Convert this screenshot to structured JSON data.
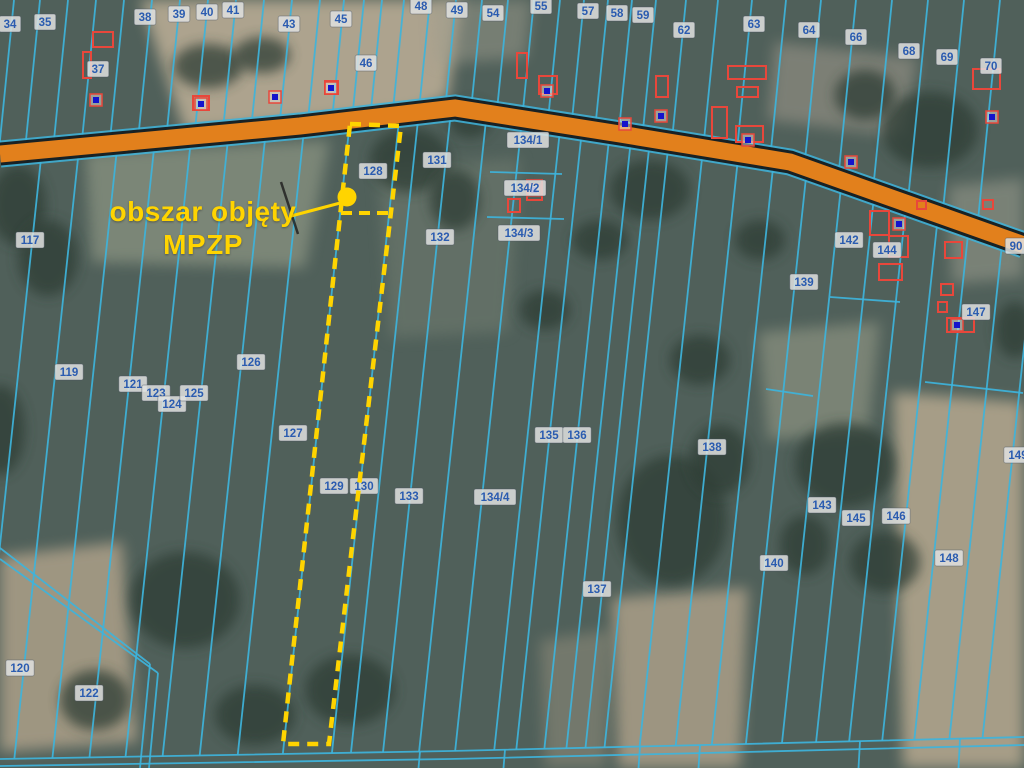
{
  "map": {
    "annotation": {
      "line1": "obszar objęty",
      "line2": "MPZP"
    },
    "colors": {
      "parcel_line": "#3eb4dc",
      "road_fill": "#e2801c",
      "road_casing": "#161616",
      "highlight": "#ffd400",
      "label_text": "#2b5cb0",
      "label_bg": "rgba(224,226,224,0.85)",
      "building": "#e8473b",
      "marker_blue": "#1414cc",
      "terrain_base": "#50605a"
    },
    "road": {
      "path": [
        [
          0,
          154
        ],
        [
          300,
          126
        ],
        [
          455,
          108
        ],
        [
          620,
          134
        ],
        [
          790,
          162
        ],
        [
          1024,
          245
        ]
      ]
    },
    "bottom_paths": [
      [
        [
          0,
          759
        ],
        [
          450,
          751
        ],
        [
          745,
          744
        ],
        [
          1024,
          737
        ]
      ],
      [
        [
          0,
          766
        ],
        [
          450,
          759
        ],
        [
          745,
          752
        ],
        [
          1024,
          745
        ]
      ]
    ],
    "diag_paths": [
      [
        [
          0,
          548
        ],
        [
          150,
          664
        ]
      ],
      [
        [
          0,
          559
        ],
        [
          158,
          673
        ]
      ],
      [
        [
          150,
          664
        ],
        [
          140,
          768
        ]
      ],
      [
        [
          158,
          673
        ],
        [
          149,
          768
        ]
      ]
    ],
    "extra_segments": [
      [
        [
          490,
          172
        ],
        [
          562,
          174
        ]
      ],
      [
        [
          487,
          217
        ],
        [
          564,
          219
        ]
      ],
      [
        [
          830,
          297
        ],
        [
          900,
          302
        ]
      ],
      [
        [
          925,
          382
        ],
        [
          1023,
          393
        ]
      ],
      [
        [
          766,
          389
        ],
        [
          813,
          396
        ]
      ]
    ],
    "stub_xs": [
      420,
      505,
      640,
      700,
      860,
      960
    ],
    "lines_below_x400": [
      15,
      52,
      90,
      127,
      163,
      200,
      237,
      275,
      320,
      369,
      388,
      420,
      456,
      492,
      531,
      553,
      581,
      603,
      622,
      641,
      676,
      712,
      748,
      782,
      818,
      852,
      885,
      918,
      950,
      985,
      1018
    ],
    "lines_above_x60": [
      8,
      34,
      62,
      90,
      118,
      146,
      174,
      202,
      230,
      258,
      286,
      314,
      338,
      358,
      376,
      398,
      424,
      450,
      476,
      502,
      528,
      554,
      578,
      602,
      626,
      650,
      680,
      712,
      746,
      780,
      815,
      850,
      886,
      922,
      958,
      994
    ],
    "parcel_labels": [
      {
        "text": "34",
        "x": 10,
        "y": 24
      },
      {
        "text": "35",
        "x": 45,
        "y": 22
      },
      {
        "text": "37",
        "x": 98,
        "y": 69
      },
      {
        "text": "38",
        "x": 145,
        "y": 17
      },
      {
        "text": "39",
        "x": 179,
        "y": 14
      },
      {
        "text": "40",
        "x": 207,
        "y": 12
      },
      {
        "text": "41",
        "x": 233,
        "y": 10
      },
      {
        "text": "43",
        "x": 289,
        "y": 24
      },
      {
        "text": "45",
        "x": 341,
        "y": 19
      },
      {
        "text": "46",
        "x": 366,
        "y": 63
      },
      {
        "text": "48",
        "x": 421,
        "y": 6
      },
      {
        "text": "49",
        "x": 457,
        "y": 10
      },
      {
        "text": "54",
        "x": 493,
        "y": 13
      },
      {
        "text": "55",
        "x": 541,
        "y": 6
      },
      {
        "text": "57",
        "x": 588,
        "y": 11
      },
      {
        "text": "58",
        "x": 617,
        "y": 13
      },
      {
        "text": "59",
        "x": 643,
        "y": 15
      },
      {
        "text": "62",
        "x": 684,
        "y": 30
      },
      {
        "text": "63",
        "x": 754,
        "y": 24
      },
      {
        "text": "64",
        "x": 809,
        "y": 30
      },
      {
        "text": "66",
        "x": 856,
        "y": 37
      },
      {
        "text": "68",
        "x": 909,
        "y": 51
      },
      {
        "text": "69",
        "x": 947,
        "y": 57
      },
      {
        "text": "70",
        "x": 991,
        "y": 66
      },
      {
        "text": "90",
        "x": 1016,
        "y": 246
      },
      {
        "text": "117",
        "x": 30,
        "y": 240
      },
      {
        "text": "119",
        "x": 69,
        "y": 372
      },
      {
        "text": "120",
        "x": 20,
        "y": 668
      },
      {
        "text": "121",
        "x": 133,
        "y": 384
      },
      {
        "text": "122",
        "x": 89,
        "y": 693
      },
      {
        "text": "123",
        "x": 156,
        "y": 393
      },
      {
        "text": "124",
        "x": 172,
        "y": 404
      },
      {
        "text": "125",
        "x": 194,
        "y": 393
      },
      {
        "text": "126",
        "x": 251,
        "y": 362
      },
      {
        "text": "127",
        "x": 293,
        "y": 433
      },
      {
        "text": "128",
        "x": 373,
        "y": 171
      },
      {
        "text": "129",
        "x": 334,
        "y": 486
      },
      {
        "text": "130",
        "x": 364,
        "y": 486
      },
      {
        "text": "131",
        "x": 437,
        "y": 160
      },
      {
        "text": "132",
        "x": 440,
        "y": 237
      },
      {
        "text": "133",
        "x": 409,
        "y": 496
      },
      {
        "text": "134/1",
        "x": 528,
        "y": 140
      },
      {
        "text": "134/2",
        "x": 525,
        "y": 188
      },
      {
        "text": "134/3",
        "x": 519,
        "y": 233
      },
      {
        "text": "134/4",
        "x": 495,
        "y": 497
      },
      {
        "text": "135",
        "x": 549,
        "y": 435
      },
      {
        "text": "136",
        "x": 577,
        "y": 435
      },
      {
        "text": "137",
        "x": 597,
        "y": 589
      },
      {
        "text": "138",
        "x": 712,
        "y": 447
      },
      {
        "text": "139",
        "x": 804,
        "y": 282
      },
      {
        "text": "140",
        "x": 774,
        "y": 563
      },
      {
        "text": "142",
        "x": 849,
        "y": 240
      },
      {
        "text": "143",
        "x": 822,
        "y": 505
      },
      {
        "text": "144",
        "x": 887,
        "y": 250
      },
      {
        "text": "145",
        "x": 856,
        "y": 518
      },
      {
        "text": "146",
        "x": 896,
        "y": 516
      },
      {
        "text": "147",
        "x": 976,
        "y": 312
      },
      {
        "text": "148",
        "x": 949,
        "y": 558
      },
      {
        "text": "149",
        "x": 1018,
        "y": 455
      }
    ],
    "buildings": [
      [
        93,
        32,
        20,
        15
      ],
      [
        83,
        52,
        8,
        26
      ],
      [
        193,
        96,
        16,
        14
      ],
      [
        325,
        81,
        13,
        13
      ],
      [
        517,
        53,
        10,
        25
      ],
      [
        539,
        76,
        18,
        18
      ],
      [
        728,
        66,
        38,
        13
      ],
      [
        737,
        87,
        21,
        10
      ],
      [
        712,
        107,
        15,
        31
      ],
      [
        736,
        126,
        27,
        16
      ],
      [
        973,
        69,
        27,
        20
      ],
      [
        656,
        76,
        12,
        21
      ],
      [
        870,
        211,
        19,
        24
      ],
      [
        889,
        236,
        19,
        21
      ],
      [
        879,
        264,
        23,
        16
      ],
      [
        945,
        242,
        17,
        16
      ],
      [
        941,
        284,
        12,
        11
      ],
      [
        938,
        302,
        9,
        10
      ],
      [
        947,
        318,
        27,
        14
      ],
      [
        508,
        199,
        12,
        13
      ],
      [
        527,
        180,
        15,
        20
      ],
      [
        917,
        201,
        9,
        8
      ],
      [
        983,
        200,
        10,
        9
      ]
    ],
    "markers": [
      [
        96,
        100
      ],
      [
        201,
        104
      ],
      [
        275,
        97
      ],
      [
        331,
        88
      ],
      [
        547,
        91
      ],
      [
        625,
        124
      ],
      [
        748,
        140
      ],
      [
        851,
        162
      ],
      [
        661,
        116
      ],
      [
        899,
        224
      ],
      [
        957,
        325
      ],
      [
        992,
        117
      ],
      [
        534,
        190
      ]
    ],
    "terrain_fields": [
      {
        "pts": [
          [
            140,
            0
          ],
          [
            462,
            0
          ],
          [
            448,
            98
          ],
          [
            412,
            112
          ],
          [
            185,
            132
          ]
        ],
        "fill": "#b2a791",
        "op": 0.95
      },
      {
        "pts": [
          [
            85,
            152
          ],
          [
            330,
            140
          ],
          [
            305,
            268
          ],
          [
            92,
            262
          ]
        ],
        "fill": "#86907f",
        "op": 0.8
      },
      {
        "pts": [
          [
            378,
            168
          ],
          [
            520,
            158
          ],
          [
            508,
            332
          ],
          [
            390,
            338
          ]
        ],
        "fill": "#6e7a6e",
        "op": 0.6
      },
      {
        "pts": [
          [
            0,
            556
          ],
          [
            122,
            542
          ],
          [
            138,
            742
          ],
          [
            0,
            752
          ]
        ],
        "fill": "#a79c86",
        "op": 0.9
      },
      {
        "pts": [
          [
            612,
            598
          ],
          [
            748,
            588
          ],
          [
            740,
            768
          ],
          [
            618,
            768
          ]
        ],
        "fill": "#ab9f88",
        "op": 0.85
      },
      {
        "pts": [
          [
            893,
            392
          ],
          [
            1024,
            402
          ],
          [
            1024,
            768
          ],
          [
            903,
            768
          ]
        ],
        "fill": "#b0a48c",
        "op": 0.9
      },
      {
        "pts": [
          [
            758,
            332
          ],
          [
            880,
            322
          ],
          [
            868,
            432
          ],
          [
            768,
            440
          ]
        ],
        "fill": "#8c9381",
        "op": 0.7
      },
      {
        "pts": [
          [
            948,
            186
          ],
          [
            1024,
            178
          ],
          [
            1024,
            278
          ],
          [
            952,
            284
          ]
        ],
        "fill": "#95988a",
        "op": 0.6
      },
      {
        "pts": [
          [
            432,
            0
          ],
          [
            532,
            0
          ],
          [
            526,
            58
          ],
          [
            436,
            64
          ]
        ],
        "fill": "#9d9c8d",
        "op": 0.5
      },
      {
        "pts": [
          [
            775,
            42
          ],
          [
            918,
            58
          ],
          [
            902,
            136
          ],
          [
            768,
            120
          ]
        ],
        "fill": "#9a9488",
        "op": 0.6
      },
      {
        "pts": [
          [
            540,
            640
          ],
          [
            612,
            630
          ],
          [
            606,
            768
          ],
          [
            545,
            768
          ]
        ],
        "fill": "#97917e",
        "op": 0.5
      }
    ],
    "terrain_trees": [
      [
        18,
        205,
        28,
        40
      ],
      [
        48,
        258,
        30,
        38
      ],
      [
        208,
        66,
        35,
        22
      ],
      [
        262,
        55,
        28,
        18
      ],
      [
        410,
        160,
        40,
        32
      ],
      [
        455,
        200,
        25,
        30
      ],
      [
        470,
        120,
        22,
        18
      ],
      [
        650,
        190,
        40,
        30
      ],
      [
        700,
        360,
        30,
        25
      ],
      [
        672,
        520,
        55,
        65
      ],
      [
        720,
        460,
        30,
        35
      ],
      [
        845,
        465,
        50,
        42
      ],
      [
        885,
        562,
        35,
        30
      ],
      [
        930,
        130,
        48,
        38
      ],
      [
        865,
        95,
        30,
        25
      ],
      [
        350,
        690,
        45,
        35
      ],
      [
        185,
        600,
        55,
        48
      ],
      [
        255,
        715,
        40,
        30
      ],
      [
        95,
        700,
        35,
        30
      ],
      [
        545,
        310,
        25,
        20
      ],
      [
        600,
        240,
        28,
        20
      ],
      [
        760,
        240,
        25,
        20
      ],
      [
        805,
        545,
        25,
        30
      ],
      [
        0,
        430,
        25,
        45
      ],
      [
        1015,
        330,
        20,
        28
      ]
    ],
    "mpzp": {
      "polygon": [
        [
          350,
          124
        ],
        [
          401,
          126
        ],
        [
          329,
          744
        ],
        [
          283,
          744
        ]
      ],
      "divider": [
        [
          341,
          213
        ],
        [
          391,
          213
        ]
      ],
      "point": [
        347,
        197
      ],
      "point_radius": 9.5,
      "leader": [
        [
          291,
          216
        ],
        [
          344,
          202
        ]
      ],
      "black_mark": [
        [
          281,
          182
        ],
        [
          298,
          234
        ]
      ]
    }
  }
}
